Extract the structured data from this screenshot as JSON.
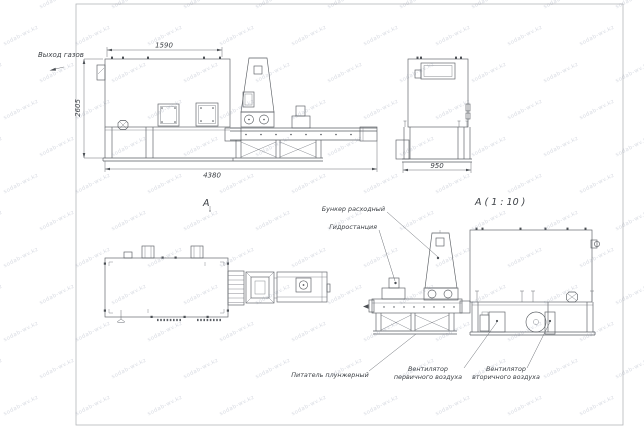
{
  "sheet": {
    "background": "#ffffff",
    "frame_color": "#b4b6ba",
    "line_color": "#5a5e63"
  },
  "watermark": {
    "text": "sodab-wv.kz"
  },
  "side_view": {
    "gas_outlet_label": "Выход газов",
    "dim_top_width": "1590",
    "dim_height": "2605",
    "dim_total_length": "4380"
  },
  "end_view": {
    "dim_width": "950"
  },
  "plan_view": {
    "section_label": "A"
  },
  "detail_view": {
    "title": "A ( 1 : 10 )",
    "callout_feed_hopper": "Бункер расходный",
    "callout_hydraulic_station": "Гидростанция",
    "callout_plunger_feeder": "Питатель плунжерный",
    "callout_primary_fan_line1": "Вентилятор",
    "callout_primary_fan_line2": "первичного воздуха",
    "callout_secondary_fan_line1": "Вентилятор",
    "callout_secondary_fan_line2": "вторичного воздуха"
  }
}
